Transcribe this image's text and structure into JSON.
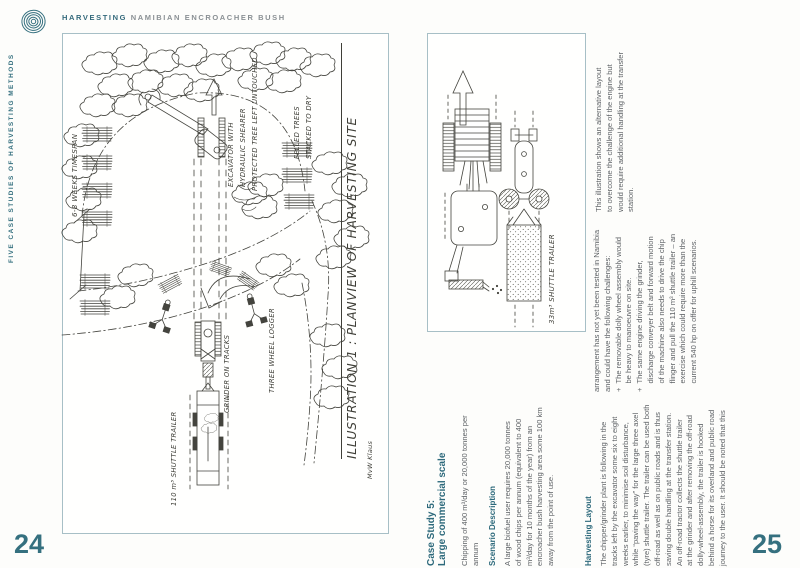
{
  "header": {
    "brand_bold": "HARVESTING",
    "brand_rest": " NAMIBIAN ENCROACHER BUSH",
    "logo": "tree-rings-logo"
  },
  "sidebar": {
    "vertical_text": "FIVE CASE STUDIES OF HARVESTING METHODS"
  },
  "page_left": {
    "page_number": "24",
    "illustration": {
      "labels": {
        "timespan": "6-8 WEEKS TIMESPAN",
        "excavator_l1": "EXCAVATOR WITH",
        "excavator_l2": "HYDRAULIC SHEARER",
        "protected": "PROTECTED TREE LEFT UNTOUCHED",
        "felled_l1": "FELLED TREES",
        "felled_l2": "STACKED TO DRY",
        "grinder": "GRINDER ON TRACKS",
        "trailer": "110 m³ SHUTTLE TRAILER",
        "logger": "THREE WHEEL LOGGER",
        "title": "ILLUSTRATION 1 : PLANVIEW OF HARVESTING SITE",
        "signature": "MvW Klaus"
      }
    }
  },
  "page_right": {
    "page_number": "25",
    "illustration": {
      "labels": {
        "trailer": "33m³ SHUTTLE TRAILER"
      }
    },
    "case_study": {
      "heading_l1": "Case Study 5:",
      "heading_l2": "Large commercial scale",
      "chipping_l1": "Chipping of 400 m³/day or 20,000 tonnes per",
      "chipping_l2": "annum"
    },
    "scenario": {
      "heading": "Scenario Description",
      "lines": [
        "A large biofuel user requires 20,000 tonnes",
        "of wood chips per annum (equivalent to 400",
        "m³/day for 10 months of the year) from an",
        "encroacher bush harvesting area some 100 km",
        "away from the point of use."
      ]
    },
    "harvesting": {
      "heading": "Harvesting Layout",
      "lines": [
        "The chipper/grinder plant is following in the",
        "tracks left by the excavator some six to eight",
        "weeks earlier, to minimise soil disturbance,",
        "while “paving the way” for the large three axel",
        "(tyre) shuttle trailer. The trailer can be used both",
        "off-road as well as on public roads and is thus",
        "saving double handling at the transfer station.",
        "An off-road tractor collects the shuttle trailer",
        "at the grinder and after removing the off-road",
        "dolly-wheel-assembly, the trailer is hooked",
        "behind a horse for its overland and public road",
        "journey to the user. It should be noted that this"
      ]
    },
    "challenges": {
      "lines": [
        "arrangement has not yet been tested in Namibia",
        "and could have the following challenges:",
        "+  The removable dolly wheel assembly would",
        "    be heavy to manoeuvre on site.",
        "+  The same engine driving the grinder,",
        "    discharge conveyer belt and forward motion",
        "    of the machine also needs to drive the chip",
        "    flinger and pull the 110 m³ shuttle trailer – an",
        "    exercise which could require more than the",
        "    current 540 hp on offer for uphill scenarios."
      ]
    },
    "caption": {
      "lines": [
        "This illustration shows an alternative layout",
        "to overcome the challenge of the engine but",
        "would require additional handling at the transfer",
        "station."
      ]
    }
  },
  "colors": {
    "teal": "#2e6a7c",
    "body_text": "#5e6266",
    "sketch": "#44443e",
    "box_border": "#a7bfc6"
  }
}
